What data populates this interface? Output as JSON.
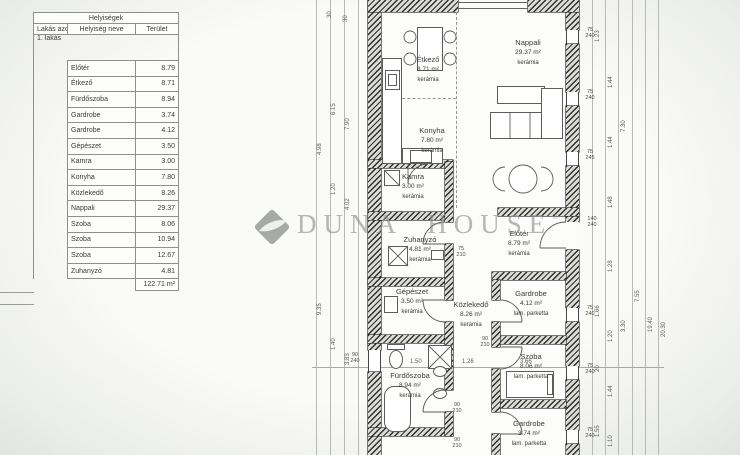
{
  "watermark": {
    "brand": "DUNA HOUSE",
    "reg": "®"
  },
  "table": {
    "title": "Helyiségek",
    "columns": {
      "id": "Lakás azonosítója",
      "name": "Helyiség neve",
      "area": "Terület"
    },
    "apartment": "1. lakás",
    "rows": [
      {
        "name": "Előtér",
        "area": "8.79"
      },
      {
        "name": "Étkező",
        "area": "8.71"
      },
      {
        "name": "Fürdőszoba",
        "area": "8.94"
      },
      {
        "name": "Gardrobe",
        "area": "3.74"
      },
      {
        "name": "Gardrobe",
        "area": "4.12"
      },
      {
        "name": "Gépészet",
        "area": "3.50"
      },
      {
        "name": "Kamra",
        "area": "3.00"
      },
      {
        "name": "Konyha",
        "area": "7.80"
      },
      {
        "name": "Közlekedő",
        "area": "8.26"
      },
      {
        "name": "Nappali",
        "area": "29.37"
      },
      {
        "name": "Szoba",
        "area": "8.06"
      },
      {
        "name": "Szoba",
        "area": "10.94"
      },
      {
        "name": "Szoba",
        "area": "12.67"
      },
      {
        "name": "Zuhanyzó",
        "area": "4.81"
      }
    ],
    "total": "122.71 m²"
  },
  "plan": {
    "rooms": [
      {
        "name": "Étkező",
        "area": "8.71 m²",
        "floor": "kerámia"
      },
      {
        "name": "Nappali",
        "area": "29.37 m²",
        "floor": "kerámia"
      },
      {
        "name": "Konyha",
        "area": "7.80 m²",
        "floor": "kerámia"
      },
      {
        "name": "Kamra",
        "area": "3.00 m²",
        "floor": "kerámia"
      },
      {
        "name": "Előtér",
        "area": "8.79 m²",
        "floor": "kerámia"
      },
      {
        "name": "Zuhanyzó",
        "area": "4.81 m²",
        "floor": "kerámia"
      },
      {
        "name": "Gépészet",
        "area": "3.50 m²",
        "floor": "kerámia"
      },
      {
        "name": "Közlekedő",
        "area": "8.26 m²",
        "floor": "kerámia"
      },
      {
        "name": "Gardrobe",
        "area": "4.12 m²",
        "floor": "lam. parketta"
      },
      {
        "name": "Szoba",
        "area": "8.06 m²",
        "floor": "lam. parketta"
      },
      {
        "name": "Fürdőszoba",
        "area": "8.94 m²",
        "floor": "kerámia"
      },
      {
        "name": "Gardrobe",
        "area": "3.74 m²",
        "floor": "lam. parketta"
      }
    ],
    "openings": [
      [
        "75",
        "240"
      ],
      [
        "75",
        "240"
      ],
      [
        "75",
        "245"
      ],
      [
        "140",
        "240"
      ],
      [
        "75",
        "240"
      ],
      [
        "75",
        "240"
      ],
      [
        "75",
        "240"
      ],
      [
        "90",
        "240"
      ],
      [
        "75",
        "210"
      ],
      [
        "90",
        "210"
      ],
      [
        "90",
        "210"
      ],
      [
        "90",
        "210"
      ]
    ],
    "dims_left": [
      "30",
      "30",
      "6.15",
      "7.90",
      "4.98",
      "1.20",
      "4.02",
      "9.35",
      "1.40",
      "3.83"
    ],
    "dims_right": [
      "1.23",
      "1.44",
      "1.44",
      "1.48",
      "1.28",
      "1.20",
      "1.44",
      "1.10",
      "7.30",
      "3.30",
      "7.55",
      "19.40",
      "20.30",
      "1.66",
      "20",
      "1.55"
    ],
    "dims_h": [
      "1.50",
      "1.26",
      "3.66"
    ]
  }
}
